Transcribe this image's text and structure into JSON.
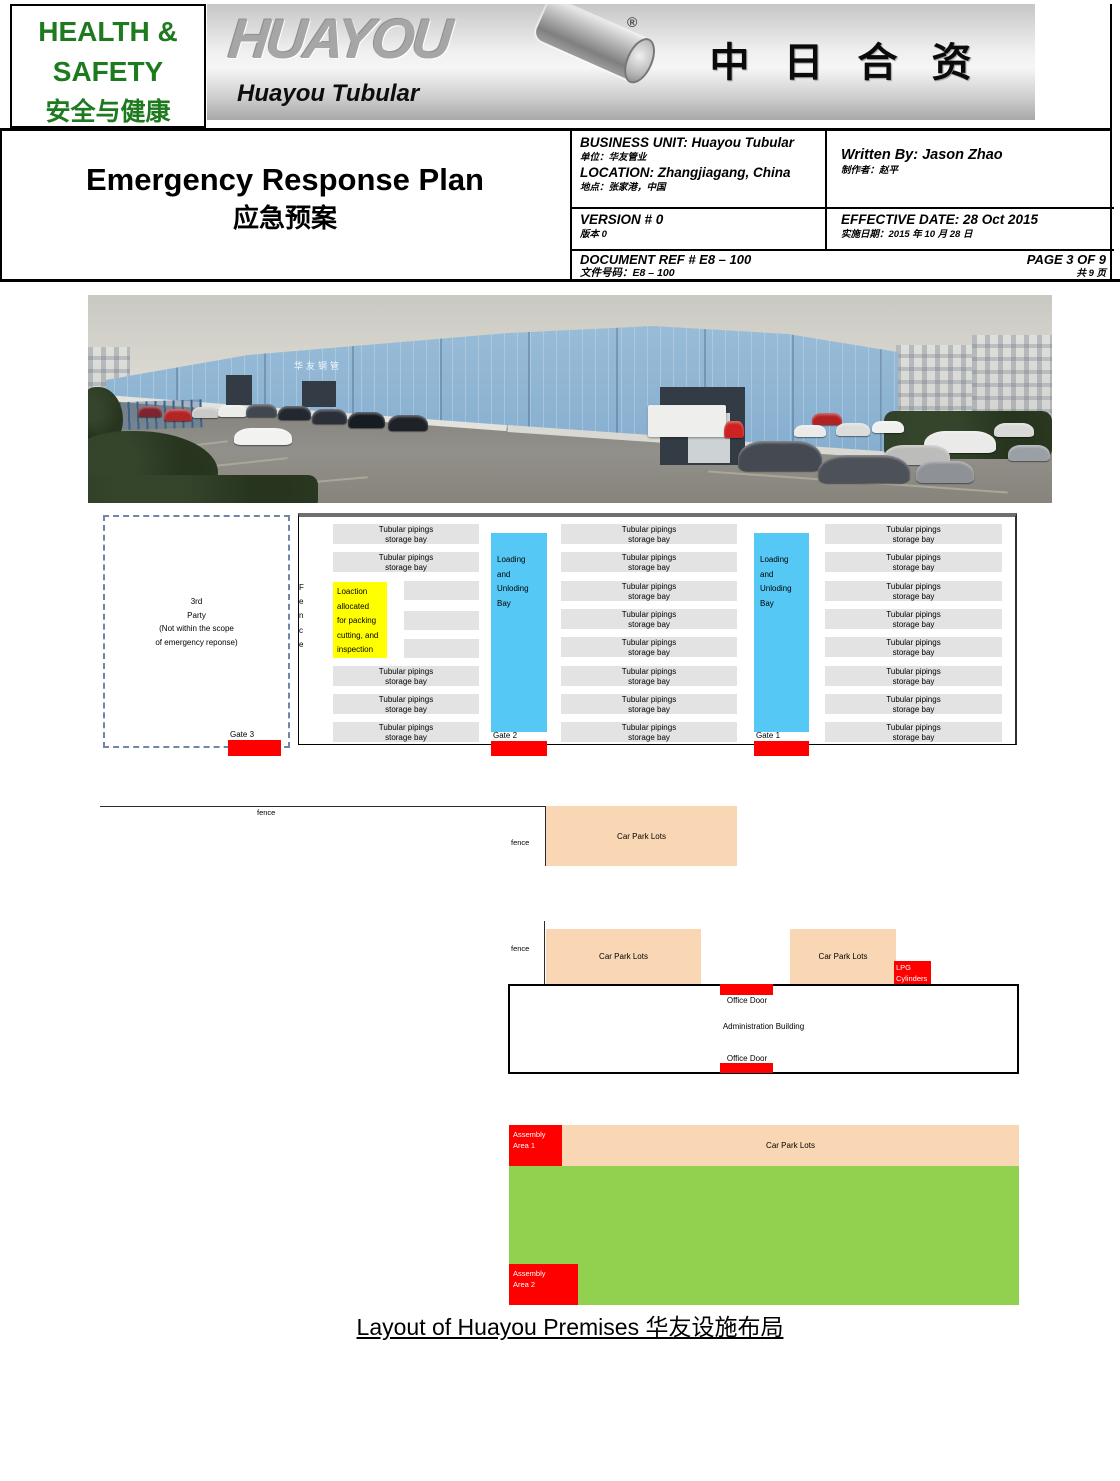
{
  "header": {
    "badge_line1": "HEALTH &",
    "badge_line2": "SAFETY",
    "badge_line3": "安全与健康",
    "logo_brand": "HUAYOU",
    "logo_registered": "®",
    "logo_subtitle": "Huayou Tubular",
    "banner_cjk": "中日合资",
    "title_en": "Emergency Response Plan",
    "title_zh": "应急预案"
  },
  "meta": {
    "business_unit_en": "BUSINESS UNIT: Huayou Tubular",
    "business_unit_zh": "单位：华友管业",
    "location_en": "LOCATION: Zhangjiagang, China",
    "location_zh": "地点：张家港，中国",
    "written_by_en": "Written By: Jason Zhao",
    "written_by_zh": "制作者：赵平",
    "version_en": "VERSION #  0",
    "version_zh": "版本 0",
    "effective_date_en": "EFFECTIVE DATE: 28 Oct 2015",
    "effective_date_zh": "实施日期：2015 年 10 月 28 日",
    "doc_ref_en": "DOCUMENT REF # E8 – 100",
    "doc_ref_zh": "文件号码：E8 – 100",
    "page_en": "PAGE 3 OF 9",
    "page_zh": "共 9 页"
  },
  "photo": {
    "building_sign": "华友钢管"
  },
  "diagram": {
    "third_party_1": "3rd",
    "third_party_2": "Party",
    "third_party_3": "(Not within the scope",
    "third_party_4": "of emergency reponse)",
    "fence_f": "F",
    "fence_e1": "e",
    "fence_n": "n",
    "fence_c": "c",
    "fence_e2": "e",
    "storage_line1": "Tubular pipings",
    "storage_line2": "storage bay",
    "yellow_1": "Loaction",
    "yellow_2": "allocated",
    "yellow_3": "for packing",
    "yellow_4": "cutting, and",
    "yellow_5": "inspection",
    "loading_1": "Loading",
    "loading_2": "and",
    "loading_3": "Unloding",
    "loading_4": "Bay",
    "gate1": "Gate 1",
    "gate2": "Gate 2",
    "gate3": "Gate 3",
    "fence_label": "fence",
    "car_park": "Car Park Lots",
    "lpg_1": "LPG",
    "lpg_2": "Cylinders",
    "admin_building": "Administration Building",
    "office_door": "Office Door",
    "assembly1_1": "Assembly",
    "assembly1_2": "Area 1",
    "assembly2_1": "Assembly",
    "assembly2_2": "Area 2"
  },
  "caption": "Layout of Huayou Premises 华友设施布局",
  "colors": {
    "header_green": "#1E7A1E",
    "gate_red": "#FF0000",
    "loading_bay_blue": "#55C8F5",
    "packing_yellow": "#FFFF00",
    "storage_gray": "#E3E3E3",
    "car_park_peach": "#FAD7B4",
    "assembly_field_green": "#92D050"
  }
}
